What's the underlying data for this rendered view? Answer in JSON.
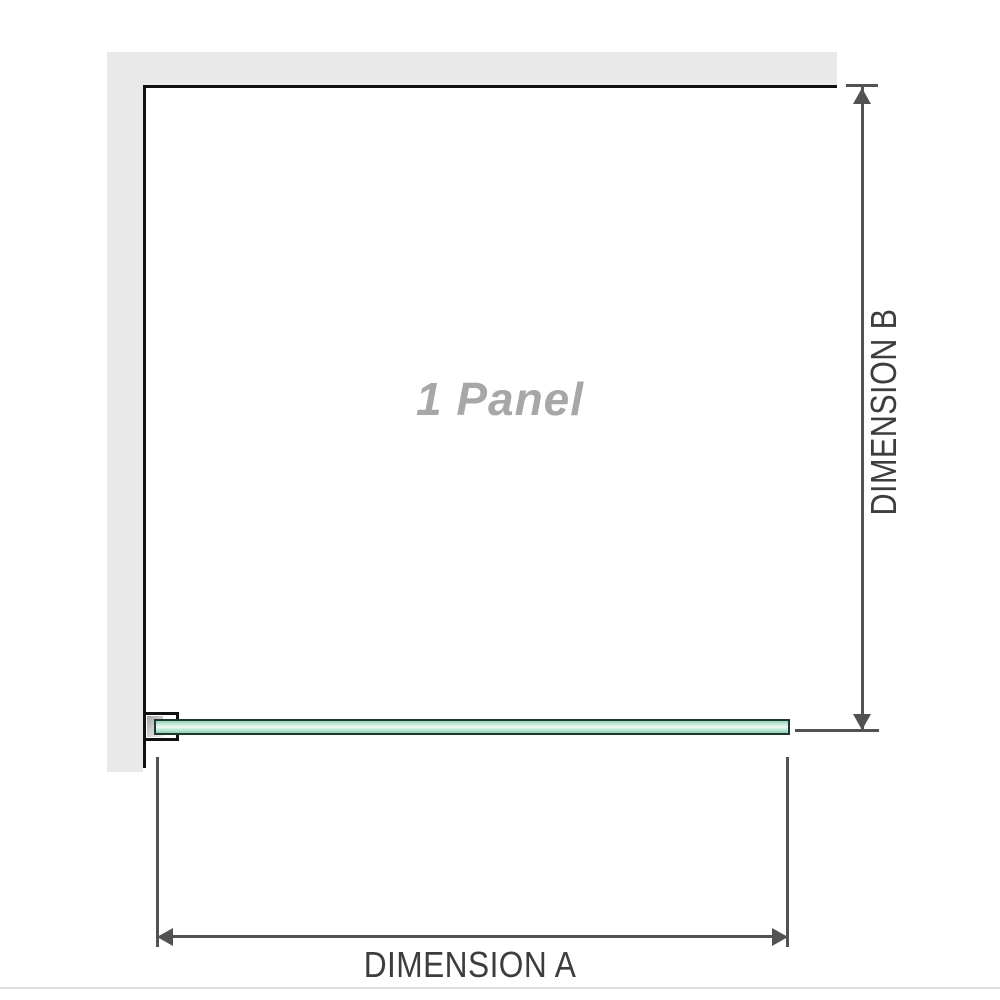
{
  "diagram": {
    "panel_label": "1 Panel",
    "dimension_a_label": "DIMENSION A",
    "dimension_b_label": "DIMENSION B"
  },
  "colors": {
    "background": "#ffffff",
    "wall_fill": "#e9e9e9",
    "outline": "#111111",
    "dimension_line": "#525252",
    "dimension_text": "#3d3d3d",
    "panel_label_text": "#a7a7a7",
    "glass_border": "#1d3b2d",
    "glass_fill_light": "#effaf4",
    "glass_fill_dark": "#96d1b7",
    "bracket_fill": "#ffffff",
    "separator": "#e4e1dd"
  }
}
